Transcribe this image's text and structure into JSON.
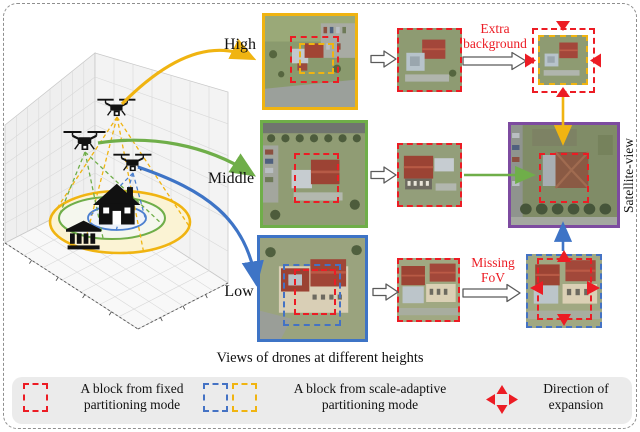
{
  "figure": {
    "caption": "Views of drones at different heights",
    "labels": {
      "high": "High",
      "middle": "Middle",
      "low": "Low"
    },
    "annotations": {
      "extra_background": "Extra background",
      "missing_fov": "Missing FoV",
      "satellite_view": "Satellite-view"
    },
    "legend": {
      "fixed_block": "A block from fixed partitioning mode",
      "adaptive_block": "A block from scale-adaptive partitioning mode",
      "expansion": "Direction of expansion"
    },
    "colors": {
      "high_accent": "#F0B411",
      "middle_accent": "#6FAE49",
      "low_accent": "#3E74C6",
      "fixed_block_red": "#EC1C24",
      "adaptive_blue": "#4472C4",
      "adaptive_yellow": "#F0B411",
      "satellite_border_purple": "#7D4BA0",
      "annotation_red": "#EC1C24"
    },
    "icons": {
      "drone": "quadcopter silhouette",
      "house": "house silhouette",
      "bank": "bank building silhouette",
      "expansion_arrows": "four red triangles pointing outward",
      "process_arrow": "white block arrow"
    }
  }
}
